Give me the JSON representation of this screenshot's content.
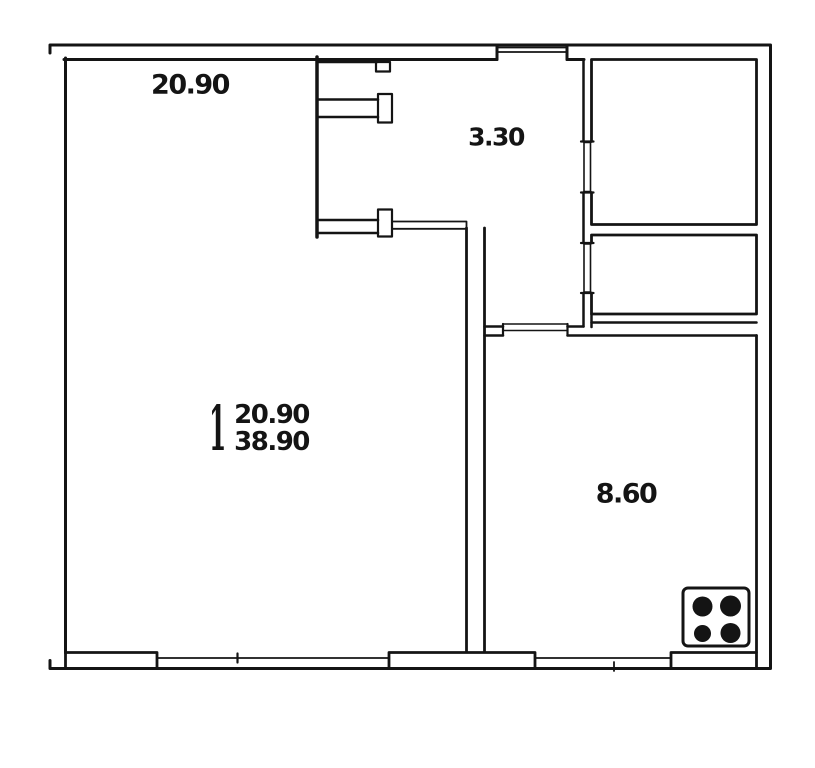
{
  "floor_plan": {
    "rooms": {
      "living_room": {
        "area": "20.90"
      },
      "hallway": {
        "area": "3.30"
      },
      "kitchen": {
        "area": "8.60"
      }
    },
    "summary": {
      "rooms_count": "1",
      "living_area": "20.90",
      "total_area": "38.90"
    },
    "colors": {
      "wall": "#141414",
      "background": "#ffffff"
    },
    "icons": [
      {
        "name": "stove-burners-icon"
      }
    ]
  }
}
